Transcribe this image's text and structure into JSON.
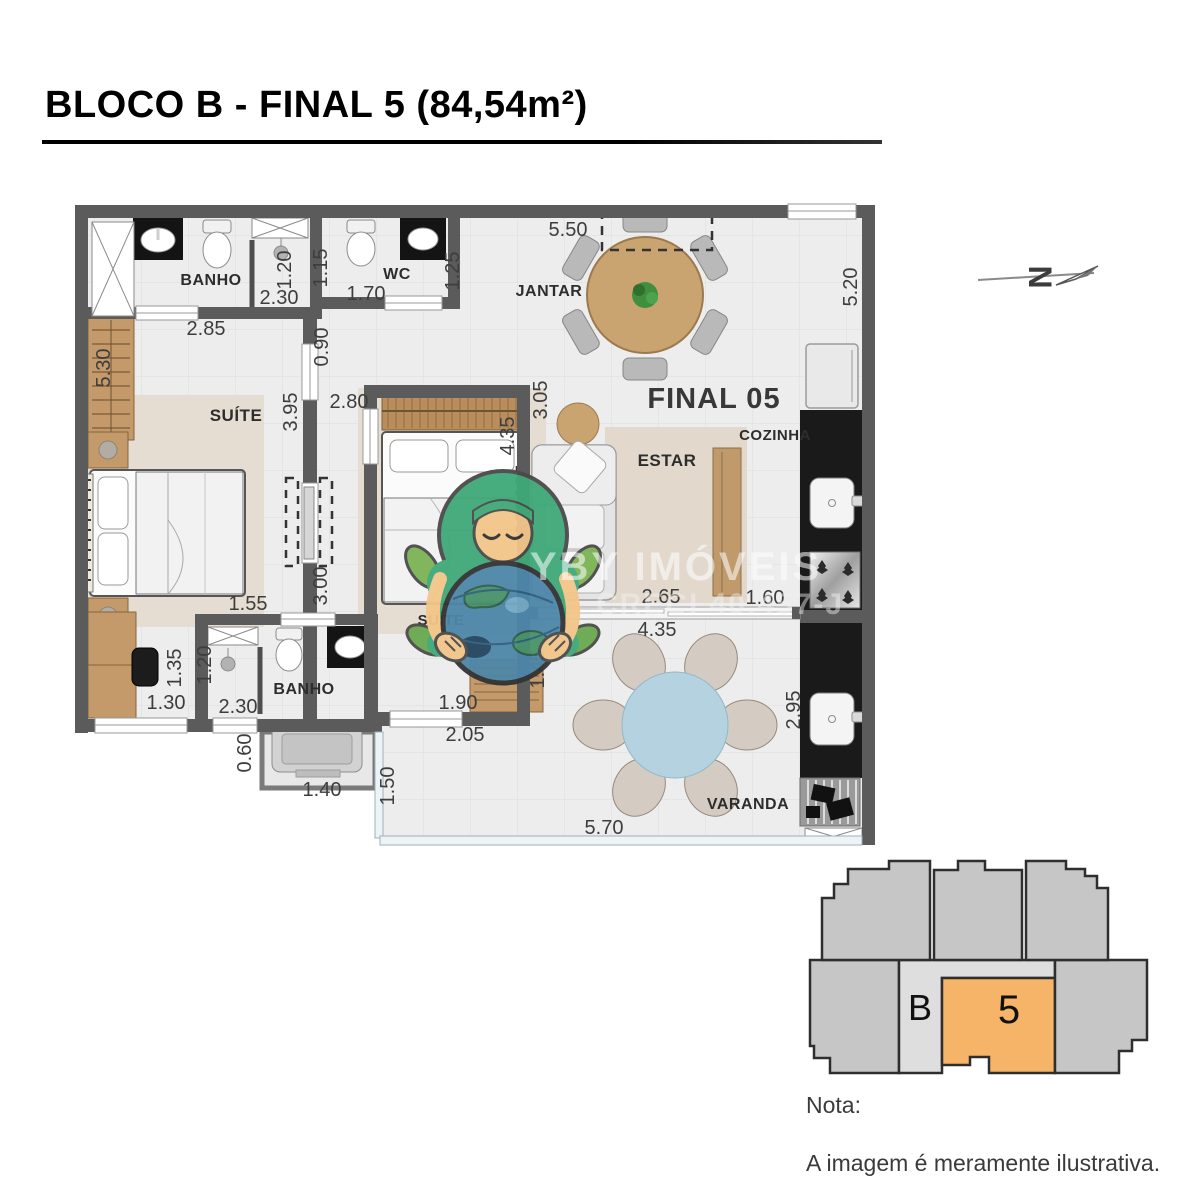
{
  "title": "BLOCO B - FINAL 5 (84,54m²)",
  "floorplan": {
    "unit_label": "FINAL 05",
    "rooms": [
      {
        "text": "BANHO",
        "x": 211,
        "y": 285,
        "fs": 16
      },
      {
        "text": "WC",
        "x": 397,
        "y": 279,
        "fs": 16
      },
      {
        "text": "JANTAR",
        "x": 549,
        "y": 296,
        "fs": 16
      },
      {
        "text": "COZINHA",
        "x": 775,
        "y": 440,
        "fs": 15
      },
      {
        "text": "SUÍTE",
        "x": 236,
        "y": 421,
        "fs": 17
      },
      {
        "text": "ESTAR",
        "x": 667,
        "y": 466,
        "fs": 17
      },
      {
        "text": "SUÍTE",
        "x": 441,
        "y": 625,
        "fs": 15
      },
      {
        "text": "BANHO",
        "x": 304,
        "y": 694,
        "fs": 16
      },
      {
        "text": "VARANDA",
        "x": 748,
        "y": 809,
        "fs": 16
      }
    ],
    "dimensions": [
      {
        "text": "5.50",
        "x": 568,
        "y": 236,
        "rot": 0
      },
      {
        "text": "1.20",
        "x": 291,
        "y": 270,
        "rot": -90
      },
      {
        "text": "2.30",
        "x": 279,
        "y": 304,
        "rot": 0
      },
      {
        "text": "1.15",
        "x": 327,
        "y": 268,
        "rot": -90
      },
      {
        "text": "1.70",
        "x": 366,
        "y": 300,
        "rot": 0
      },
      {
        "text": "1.25",
        "x": 459,
        "y": 271,
        "rot": -90
      },
      {
        "text": "2.85",
        "x": 206,
        "y": 335,
        "rot": 0
      },
      {
        "text": "0.90",
        "x": 328,
        "y": 347,
        "rot": -90
      },
      {
        "text": "5.30",
        "x": 110,
        "y": 368,
        "rot": -90
      },
      {
        "text": "5.20",
        "x": 857,
        "y": 287,
        "rot": -90
      },
      {
        "text": "3.95",
        "x": 297,
        "y": 412,
        "rot": -90
      },
      {
        "text": "2.80",
        "x": 349,
        "y": 408,
        "rot": 0
      },
      {
        "text": "3.05",
        "x": 547,
        "y": 400,
        "rot": -90
      },
      {
        "text": "4.35",
        "x": 514,
        "y": 436,
        "rot": -90
      },
      {
        "text": "3.00",
        "x": 327,
        "y": 586,
        "rot": -90
      },
      {
        "text": "1.55",
        "x": 248,
        "y": 610,
        "rot": 0
      },
      {
        "text": "2.65",
        "x": 661,
        "y": 603,
        "rot": 0
      },
      {
        "text": "1.60",
        "x": 765,
        "y": 604,
        "rot": 0
      },
      {
        "text": "4.35",
        "x": 657,
        "y": 636,
        "rot": 0
      },
      {
        "text": "1.35",
        "x": 181,
        "y": 668,
        "rot": -90
      },
      {
        "text": "1.20",
        "x": 211,
        "y": 665,
        "rot": -90
      },
      {
        "text": "1.30",
        "x": 166,
        "y": 709,
        "rot": 0
      },
      {
        "text": "2.30",
        "x": 238,
        "y": 713,
        "rot": 0
      },
      {
        "text": "0.60",
        "x": 251,
        "y": 753,
        "rot": -90
      },
      {
        "text": "1.40",
        "x": 322,
        "y": 796,
        "rot": 0
      },
      {
        "text": "1.50",
        "x": 394,
        "y": 786,
        "rot": -90
      },
      {
        "text": "1.90",
        "x": 458,
        "y": 709,
        "rot": 0
      },
      {
        "text": "2.05",
        "x": 465,
        "y": 741,
        "rot": 0
      },
      {
        "text": "1.45",
        "x": 544,
        "y": 669,
        "rot": -90
      },
      {
        "text": "2.95",
        "x": 800,
        "y": 710,
        "rot": -90
      },
      {
        "text": "5.70",
        "x": 604,
        "y": 834,
        "rot": 0
      }
    ]
  },
  "watermark": {
    "name": "YBY IMÓVEIS",
    "creci": "CRECI 40.457-J"
  },
  "north": {
    "label": "N"
  },
  "keyplan": {
    "block_label": "B",
    "unit_label": "5"
  },
  "notes": {
    "heading": "Nota:",
    "body": "A imagem é meramente ilustrativa."
  },
  "colors": {
    "wall": "#5b5b5b",
    "floor": "#ededed",
    "rug": "#e5ddd2",
    "wood": "#c49a6b",
    "counter": "#1a1a1a",
    "keyplan_unit": "#f5b467",
    "keyplan_gray": "#c6c6c6",
    "keyplan_corridor": "#dedede"
  }
}
